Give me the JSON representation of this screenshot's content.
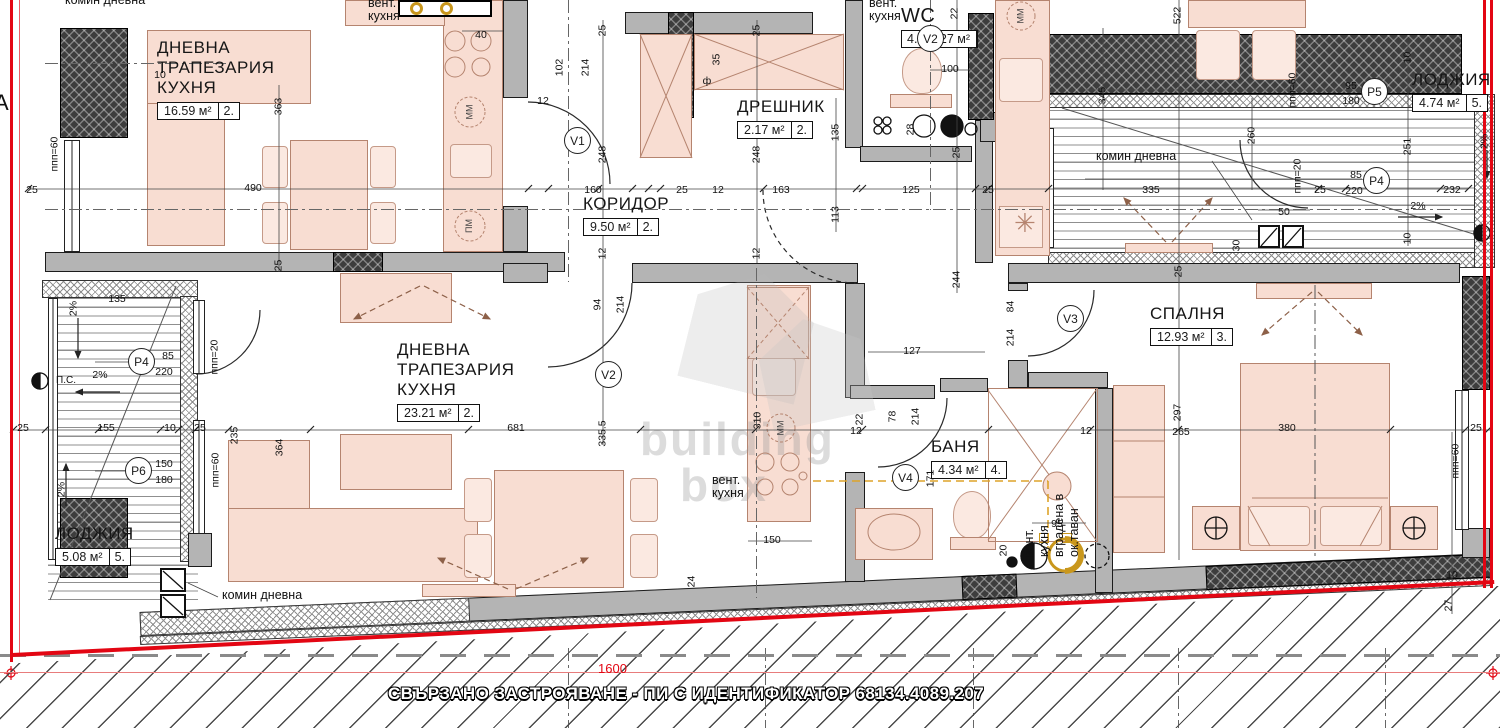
{
  "bottom": {
    "note": "СВЪРЗАНО ЗАСТРОЯВАНЕ - ПИ С ИДЕНТИФИКАТОР 68134.4089.207",
    "red_dim": "1600"
  },
  "watermark": {
    "line1": "building",
    "line2": "box"
  },
  "edge_label": "А",
  "colors": {
    "boundary_red": "#e30613",
    "wall_gray": "#b4b4b4",
    "furniture_pink": "#f8ddd2",
    "vent_orange": "#dda32a"
  },
  "rooms": [
    {
      "id": "living1",
      "name": "ДНЕВНА\nТРАПЕЗАРИЯ\nКУХНЯ",
      "area": "16.59 м²",
      "num": "2.",
      "x": 157,
      "y": 38,
      "num_first": false
    },
    {
      "id": "corridor",
      "name": "КОРИДОР",
      "area": "9.50 м²",
      "num": "2.",
      "x": 583,
      "y": 194,
      "num_first": false
    },
    {
      "id": "dreshnik",
      "name": "ДРЕШНИК",
      "area": "2.17 м²",
      "num": "2.",
      "x": 737,
      "y": 97,
      "num_first": false
    },
    {
      "id": "wc",
      "name": "WC",
      "area": "2.27 м²",
      "num": "4.",
      "x": 901,
      "y": 6,
      "num_first": true
    },
    {
      "id": "loggia-top",
      "name": "ЛОДЖИЯ",
      "area": "4.74 м²",
      "num": "5.",
      "x": 1412,
      "y": 70,
      "num_first": false
    },
    {
      "id": "living2",
      "name": "ДНЕВНА\nТРАПЕЗАРИЯ\nКУХНЯ",
      "area": "23.21 м²",
      "num": "2.",
      "x": 397,
      "y": 340,
      "num_first": false
    },
    {
      "id": "banya",
      "name": "БАНЯ",
      "area": "4.34 м²",
      "num": "4.",
      "x": 931,
      "y": 437,
      "num_first": false
    },
    {
      "id": "bedroom",
      "name": "СПАЛНЯ",
      "area": "12.93 м²",
      "num": "3.",
      "x": 1150,
      "y": 304,
      "num_first": false
    },
    {
      "id": "loggia-bottom",
      "name": "ЛОДЖИЯ",
      "area": "5.08 м²",
      "num": "5.",
      "x": 55,
      "y": 524,
      "num_first": false
    }
  ],
  "markers": [
    {
      "t": "V1",
      "x": 577,
      "y": 140
    },
    {
      "t": "V2",
      "x": 930,
      "y": 38
    },
    {
      "t": "V2",
      "x": 608,
      "y": 374
    },
    {
      "t": "V3",
      "x": 1070,
      "y": 318
    },
    {
      "t": "V4",
      "x": 905,
      "y": 477
    },
    {
      "t": "Р5",
      "x": 1374,
      "y": 91
    },
    {
      "t": "Р4",
      "x": 1376,
      "y": 180
    },
    {
      "t": "Р4",
      "x": 141,
      "y": 361
    },
    {
      "t": "Р6",
      "x": 138,
      "y": 470
    }
  ],
  "dims": [
    {
      "t": "10",
      "x": 160,
      "y": 70
    },
    {
      "t": "363",
      "x": 279,
      "y": 101,
      "v": 1
    },
    {
      "t": "490",
      "x": 253,
      "y": 183
    },
    {
      "t": "25",
      "x": 32,
      "y": 185
    },
    {
      "t": "25",
      "x": 279,
      "y": 260,
      "v": 1
    },
    {
      "t": "40",
      "x": 481,
      "y": 30
    },
    {
      "t": "ппп=60",
      "x": 55,
      "y": 152,
      "v": 1
    },
    {
      "t": "25",
      "x": 603,
      "y": 25,
      "v": 1
    },
    {
      "t": "102",
      "x": 560,
      "y": 62,
      "v": 1
    },
    {
      "t": "214",
      "x": 586,
      "y": 62,
      "v": 1
    },
    {
      "t": "12",
      "x": 543,
      "y": 96
    },
    {
      "t": "248",
      "x": 603,
      "y": 149,
      "v": 1
    },
    {
      "t": "12",
      "x": 603,
      "y": 248,
      "v": 1
    },
    {
      "t": "160",
      "x": 593,
      "y": 185
    },
    {
      "t": "25",
      "x": 682,
      "y": 185
    },
    {
      "t": "12",
      "x": 718,
      "y": 185
    },
    {
      "t": "163",
      "x": 781,
      "y": 185
    },
    {
      "t": "125",
      "x": 911,
      "y": 185
    },
    {
      "t": "25",
      "x": 988,
      "y": 185
    },
    {
      "t": "25",
      "x": 757,
      "y": 25,
      "v": 1
    },
    {
      "t": "35",
      "x": 717,
      "y": 54,
      "v": 1
    },
    {
      "t": "ф",
      "x": 707,
      "y": 76
    },
    {
      "t": "248",
      "x": 757,
      "y": 149,
      "v": 1
    },
    {
      "t": "12",
      "x": 757,
      "y": 248,
      "v": 1
    },
    {
      "t": "135",
      "x": 836,
      "y": 127,
      "v": 1
    },
    {
      "t": "113",
      "x": 836,
      "y": 209,
      "v": 1
    },
    {
      "t": "22",
      "x": 955,
      "y": 8,
      "v": 1
    },
    {
      "t": "28",
      "x": 911,
      "y": 124,
      "v": 1
    },
    {
      "t": "25",
      "x": 957,
      "y": 147,
      "v": 1
    },
    {
      "t": "100",
      "x": 950,
      "y": 64
    },
    {
      "t": "244",
      "x": 957,
      "y": 274,
      "v": 1
    },
    {
      "t": "345",
      "x": 1103,
      "y": 90,
      "v": 1
    },
    {
      "t": "522",
      "x": 1178,
      "y": 10,
      "v": 1
    },
    {
      "t": "260",
      "x": 1252,
      "y": 130,
      "v": 1
    },
    {
      "t": "335",
      "x": 1151,
      "y": 185
    },
    {
      "t": "ппп=60",
      "x": 1293,
      "y": 88,
      "v": 1
    },
    {
      "t": "ппп=20",
      "x": 1298,
      "y": 174,
      "v": 1
    },
    {
      "t": "25",
      "x": 1320,
      "y": 185
    },
    {
      "t": "50",
      "x": 1284,
      "y": 207
    },
    {
      "t": "30",
      "x": 1237,
      "y": 240,
      "v": 1
    },
    {
      "t": "25",
      "x": 1179,
      "y": 266,
      "v": 1
    },
    {
      "t": "10",
      "x": 1408,
      "y": 52,
      "v": 1
    },
    {
      "t": "95",
      "x": 1351,
      "y": 81
    },
    {
      "t": "180",
      "x": 1351,
      "y": 96
    },
    {
      "t": "85",
      "x": 1356,
      "y": 170
    },
    {
      "t": "220",
      "x": 1354,
      "y": 186
    },
    {
      "t": "251",
      "x": 1408,
      "y": 141,
      "v": 1
    },
    {
      "t": "232",
      "x": 1452,
      "y": 185
    },
    {
      "t": "10",
      "x": 1408,
      "y": 233,
      "v": 1
    },
    {
      "t": "94",
      "x": 598,
      "y": 299,
      "v": 1
    },
    {
      "t": "214",
      "x": 621,
      "y": 299,
      "v": 1
    },
    {
      "t": "681",
      "x": 516,
      "y": 423
    },
    {
      "t": "335.5",
      "x": 603,
      "y": 428,
      "v": 1
    },
    {
      "t": "24",
      "x": 692,
      "y": 576,
      "v": 1
    },
    {
      "t": "25",
      "x": 23,
      "y": 423
    },
    {
      "t": "155",
      "x": 106,
      "y": 423
    },
    {
      "t": "10",
      "x": 170,
      "y": 423
    },
    {
      "t": "25",
      "x": 200,
      "y": 423
    },
    {
      "t": "235",
      "x": 235,
      "y": 430,
      "v": 1
    },
    {
      "t": "364",
      "x": 280,
      "y": 442,
      "v": 1
    },
    {
      "t": "135",
      "x": 117,
      "y": 294
    },
    {
      "t": "85",
      "x": 168,
      "y": 351
    },
    {
      "t": "220",
      "x": 164,
      "y": 367
    },
    {
      "t": "150",
      "x": 164,
      "y": 459
    },
    {
      "t": "180",
      "x": 164,
      "y": 475
    },
    {
      "t": "ппп=20",
      "x": 215,
      "y": 355,
      "v": 1
    },
    {
      "t": "ппп=60",
      "x": 216,
      "y": 468,
      "v": 1
    },
    {
      "t": "2%",
      "x": 100,
      "y": 370
    },
    {
      "t": "2%",
      "x": 74,
      "y": 303,
      "v": 1
    },
    {
      "t": "2%",
      "x": 62,
      "y": 484,
      "v": 1
    },
    {
      "t": "2%",
      "x": 1418,
      "y": 201
    },
    {
      "t": "2%",
      "x": 1485,
      "y": 136,
      "v": 1
    },
    {
      "t": "310",
      "x": 758,
      "y": 415,
      "v": 1
    },
    {
      "t": "150",
      "x": 772,
      "y": 535
    },
    {
      "t": "22",
      "x": 860,
      "y": 414,
      "v": 1
    },
    {
      "t": "12",
      "x": 856,
      "y": 426
    },
    {
      "t": "127",
      "x": 912,
      "y": 346
    },
    {
      "t": "78",
      "x": 893,
      "y": 411,
      "v": 1
    },
    {
      "t": "214",
      "x": 916,
      "y": 411,
      "v": 1
    },
    {
      "t": "84",
      "x": 1011,
      "y": 301,
      "v": 1
    },
    {
      "t": "214",
      "x": 1011,
      "y": 332,
      "v": 1
    },
    {
      "t": "265",
      "x": 1181,
      "y": 427
    },
    {
      "t": "12",
      "x": 1086,
      "y": 426
    },
    {
      "t": "171",
      "x": 931,
      "y": 473,
      "v": 1
    },
    {
      "t": "95",
      "x": 1057,
      "y": 519
    },
    {
      "t": "20",
      "x": 1004,
      "y": 545,
      "v": 1
    },
    {
      "t": "297",
      "x": 1178,
      "y": 407,
      "v": 1
    },
    {
      "t": "380",
      "x": 1287,
      "y": 423
    },
    {
      "t": "25",
      "x": 1476,
      "y": 423
    },
    {
      "t": "ппп=60",
      "x": 1456,
      "y": 459,
      "v": 1
    },
    {
      "t": "10",
      "x": 1452,
      "y": 570
    },
    {
      "t": "27",
      "x": 1449,
      "y": 600,
      "v": 1
    }
  ],
  "notes": [
    {
      "t": "комин дневна",
      "x": 65,
      "y": -6
    },
    {
      "t": "вент.\nкухня",
      "x": 368,
      "y": -3
    },
    {
      "t": "вент.\nкухня",
      "x": 869,
      "y": -3
    },
    {
      "t": "комин дневна",
      "x": 1096,
      "y": 150
    },
    {
      "t": "комин дневна",
      "x": 222,
      "y": 589
    },
    {
      "t": "вент.\nкухня",
      "x": 712,
      "y": 474
    },
    {
      "t": "П.С.",
      "x": 56,
      "y": 374,
      "size": 10
    }
  ],
  "appliance_labels": [
    {
      "t": "ММ",
      "x": 462,
      "y": 107
    },
    {
      "t": "ПМ",
      "x": 462,
      "y": 221
    },
    {
      "t": "ММ",
      "x": 1013,
      "y": 11
    },
    {
      "t": "ММ",
      "x": 773,
      "y": 423
    }
  ],
  "builtin_note": {
    "lines": [
      "вент.",
      "кухня",
      "вградена в",
      "ок.таван"
    ],
    "x": 1022,
    "y": 557
  }
}
